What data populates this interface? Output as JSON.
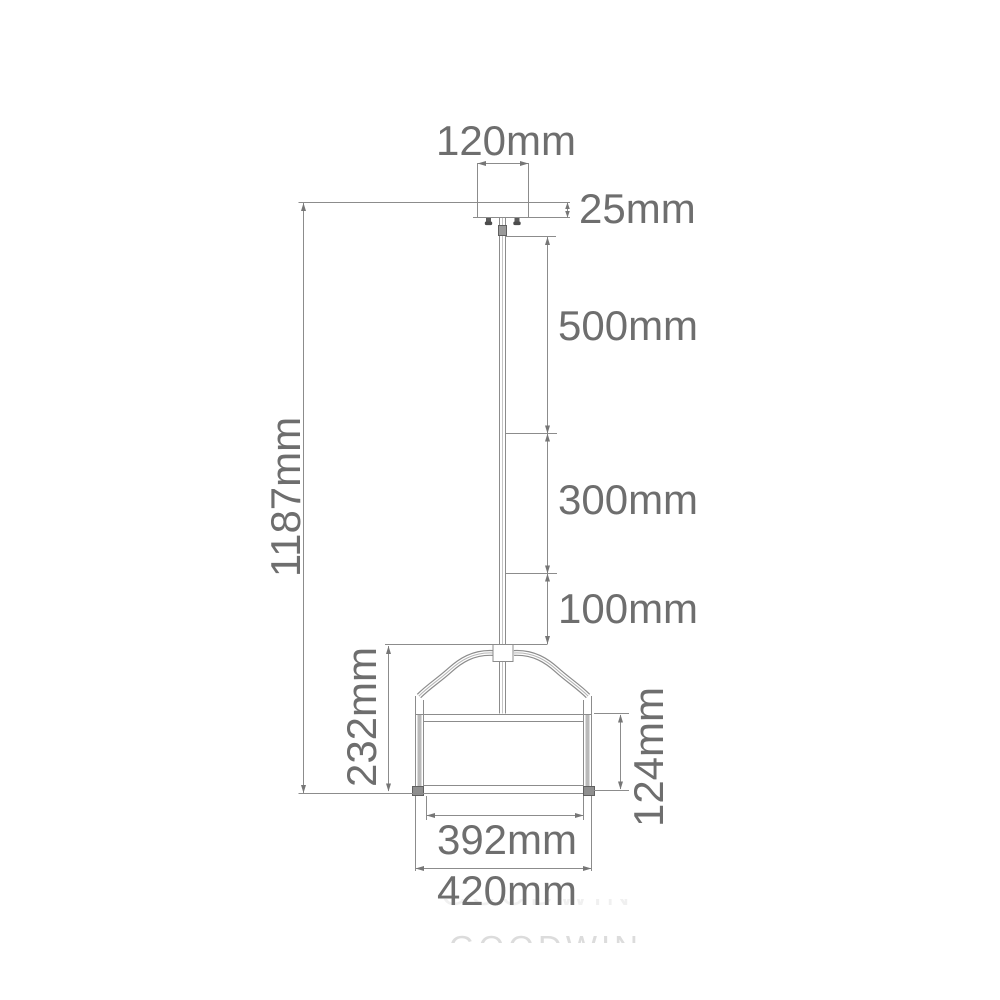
{
  "diagram": {
    "title": "pendant-light-dimension-drawing",
    "dimensions": {
      "canopy_width": "120mm",
      "canopy_height": "25mm",
      "rod_section_upper": "500mm",
      "rod_section_middle": "300mm",
      "rod_section_lower": "100mm",
      "overall_drop": "1187mm",
      "shade_total_height": "232mm",
      "drum_height": "124mm",
      "shade_inner_diameter": "392mm",
      "shade_outer_diameter": "420mm"
    },
    "watermark": "GOODWIN",
    "colors": {
      "line": "#8c8c8c",
      "arrow": "#767676",
      "text": "#6e6e6e",
      "background": "#ffffff"
    }
  }
}
